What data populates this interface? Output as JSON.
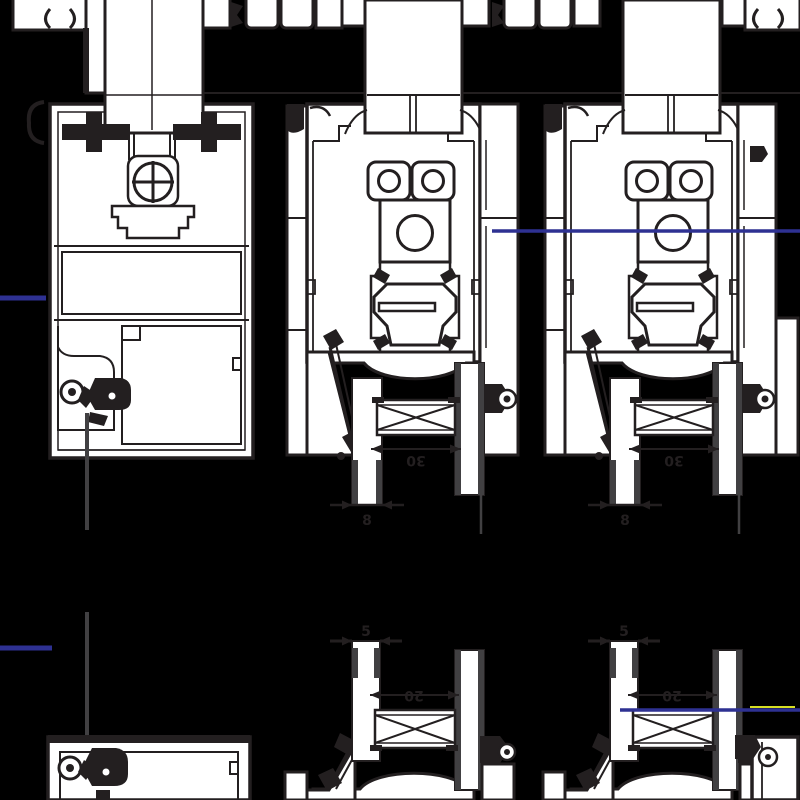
{
  "document": {
    "type": "technical-drawing",
    "title": "Aluminium window profile cross-sections",
    "background": "#000000"
  },
  "colors": {
    "ink": "#231f20",
    "profile_fill": "#ffffff",
    "accent_blue": "#2e3192",
    "glass_gray": "#414042",
    "highlight_yellow": "#d7df23"
  },
  "sections": {
    "top_left": "fixed-frame-with-infill-panel-and-screw-boss",
    "top_middle": "sliding-sash-section-with-rollers-and-glazing-spacer",
    "top_right": "sliding-sash-section-with-rollers-and-glazing-spacer",
    "bottom_left": "fixed-frame-partial-section-mirrored",
    "bottom_middle": "sliding-sash-partial-section-mirrored",
    "bottom_right": "sliding-sash-partial-section-mirrored"
  },
  "dimensions": {
    "top_sections": {
      "spacer_width": "30",
      "glass_thickness": "8"
    },
    "bottom_sections": {
      "glass_thickness": "5",
      "spacer_width": "20"
    }
  }
}
